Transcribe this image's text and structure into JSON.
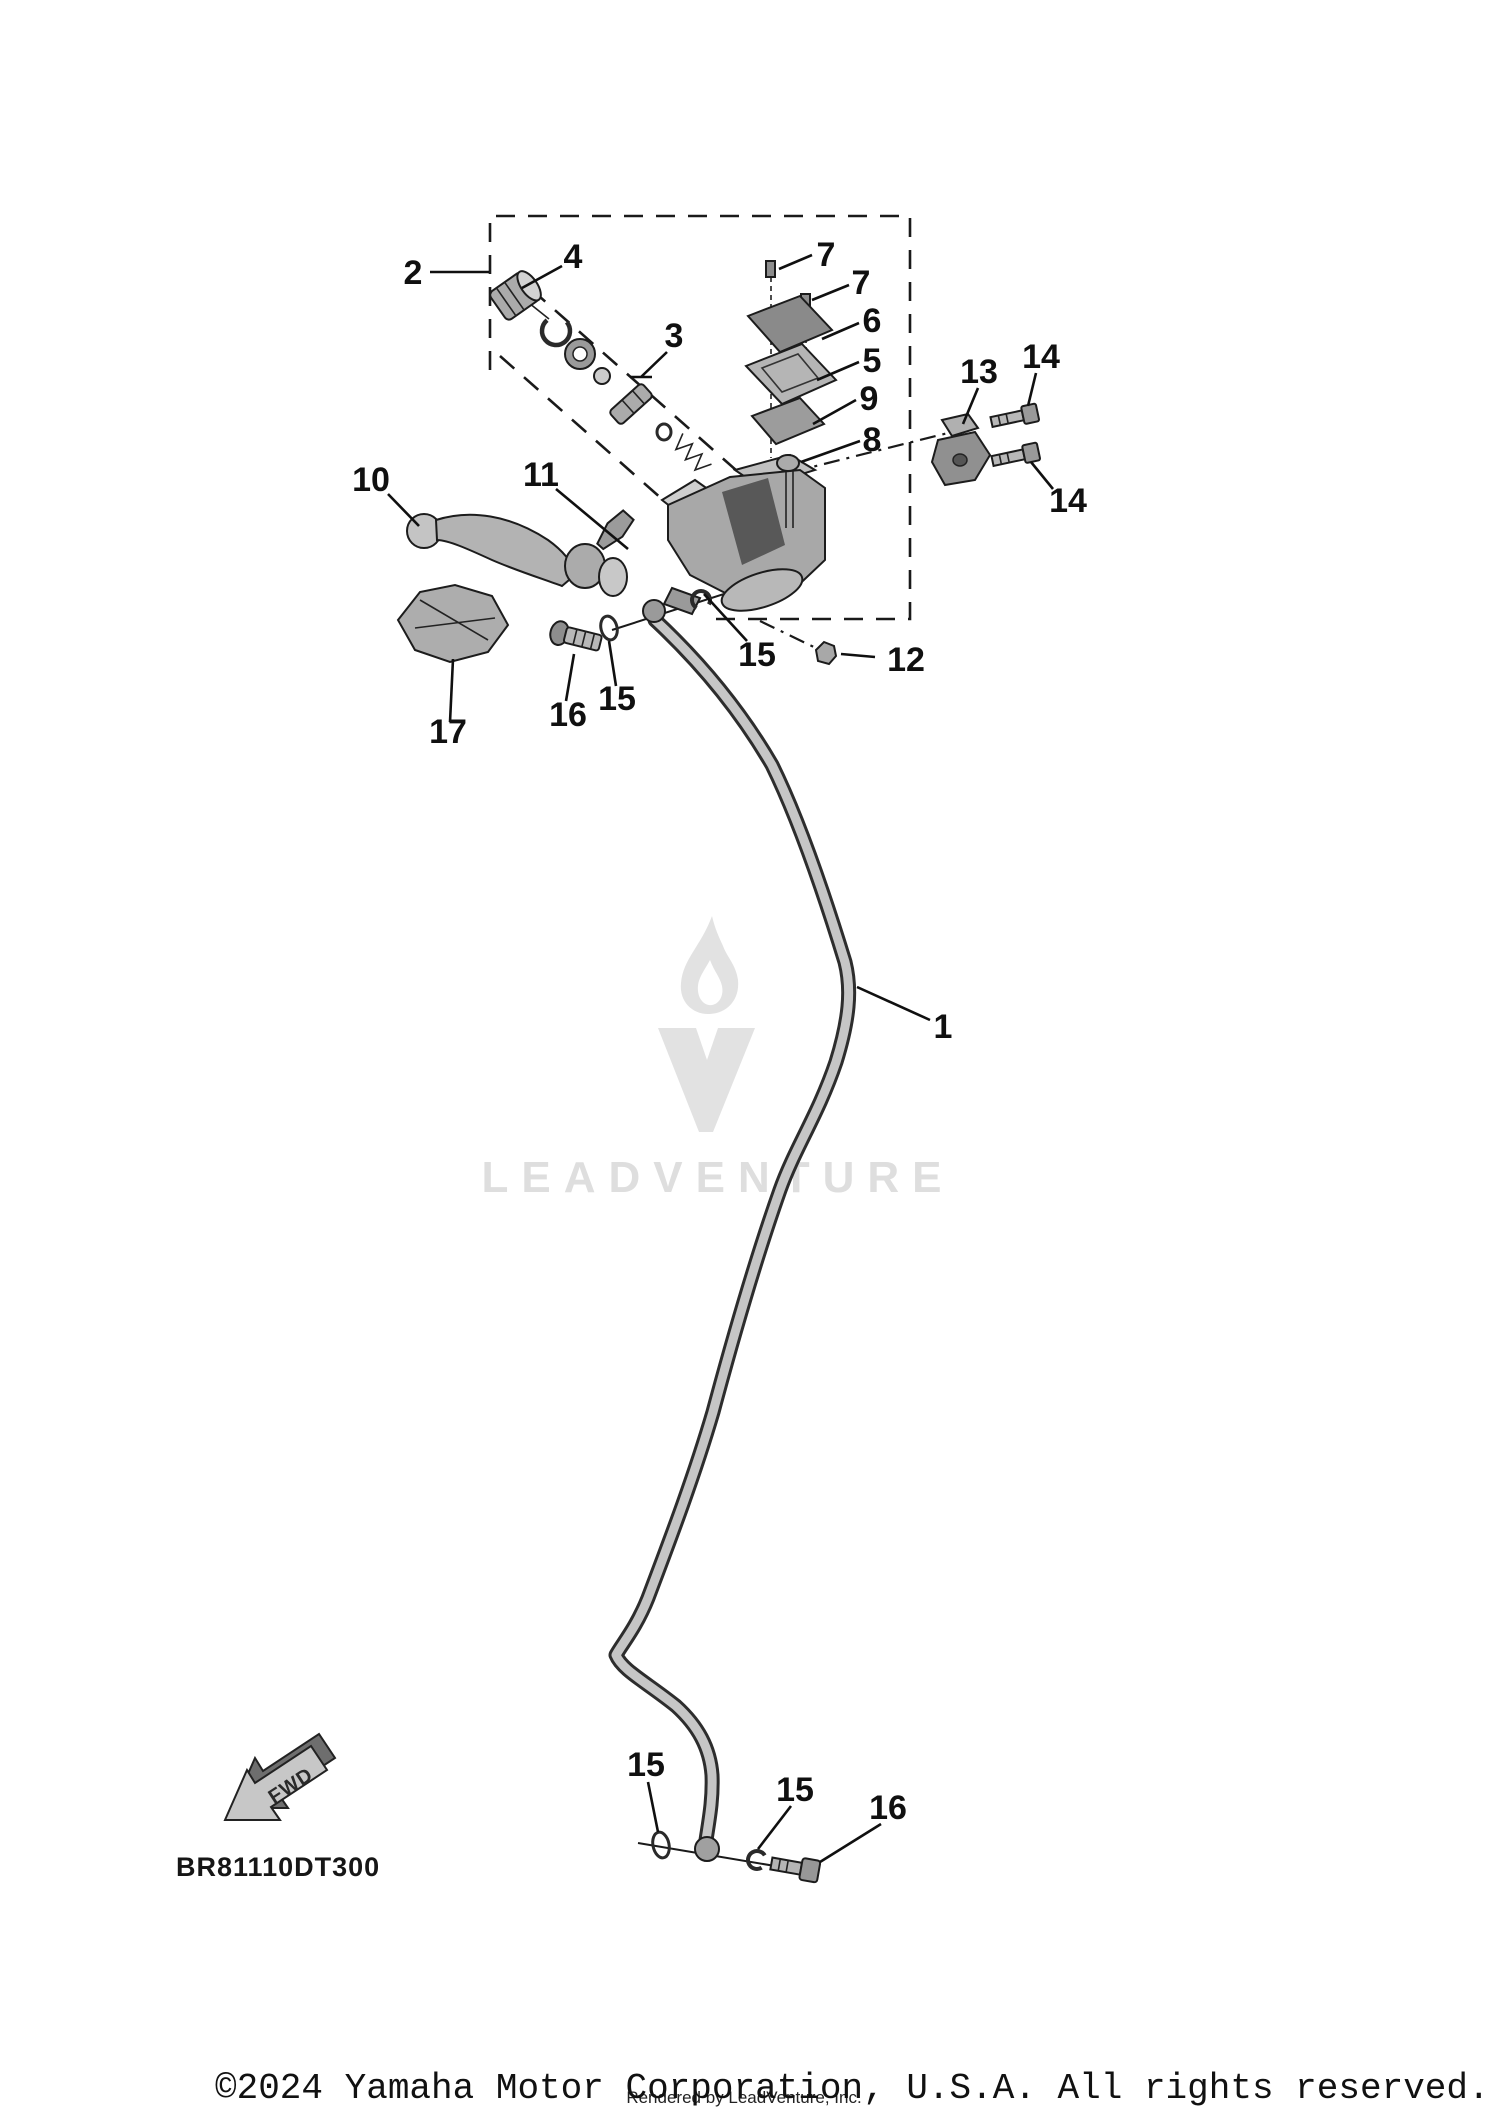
{
  "diagram": {
    "title_hidden": "",
    "watermark": {
      "brand": "LEADVENTURE"
    },
    "fwd_arrow": {
      "label": "FWD"
    },
    "part_code": "BR81110DT300",
    "footer": {
      "copyright": "©2024 Yamaha Motor Corporation, U.S.A. All rights reserved.",
      "rendered_by": "Rendered by LeadVenture, Inc."
    },
    "callouts": [
      {
        "label": "1"
      },
      {
        "label": "2"
      },
      {
        "label": "3"
      },
      {
        "label": "4"
      },
      {
        "label": "5"
      },
      {
        "label": "6"
      },
      {
        "label": "7"
      },
      {
        "label": "7"
      },
      {
        "label": "8"
      },
      {
        "label": "9"
      },
      {
        "label": "10"
      },
      {
        "label": "11"
      },
      {
        "label": "12"
      },
      {
        "label": "13"
      },
      {
        "label": "14"
      },
      {
        "label": "14"
      },
      {
        "label": "15"
      },
      {
        "label": "15"
      },
      {
        "label": "15"
      },
      {
        "label": "15"
      },
      {
        "label": "16"
      },
      {
        "label": "16"
      },
      {
        "label": "17"
      }
    ]
  }
}
